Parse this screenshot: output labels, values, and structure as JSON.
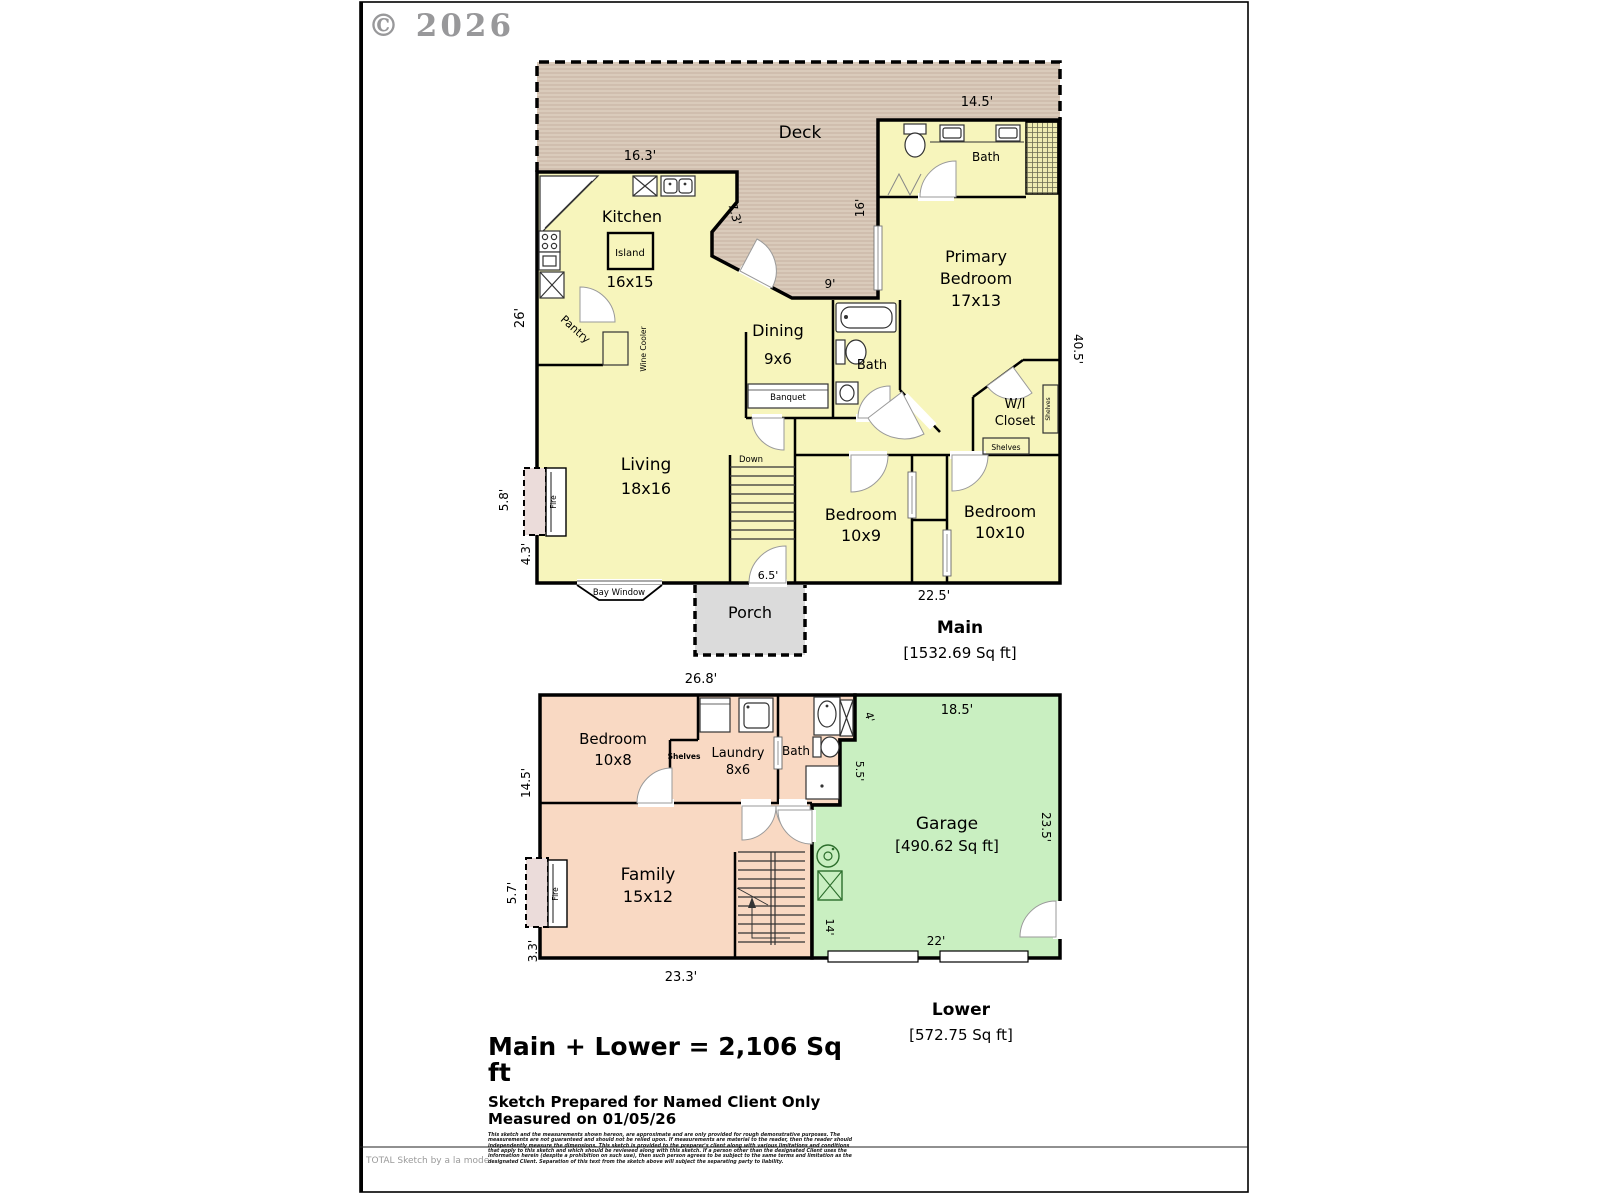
{
  "watermark": "© 2026",
  "main": {
    "title": "Main",
    "area": "[1532.69 Sq ft]",
    "deck": "Deck",
    "kitchen": "Kitchen",
    "kitchen_size": "16x15",
    "island": "Island",
    "pantry": "Pantry",
    "wine_cooler": "Wine Cooler",
    "dining": "Dining",
    "dining_size": "9x6",
    "banquet": "Banquet",
    "bath_top": "Bath",
    "bath_mid": "Bath",
    "primary_line1": "Primary",
    "primary_line2": "Bedroom",
    "primary_size": "17x13",
    "wic_line1": "W/I",
    "wic_line2": "Closet",
    "shelves_strip": "Shelves",
    "shelves_box": "Shelves",
    "living": "Living",
    "living_size": "18x16",
    "down": "Down",
    "fire": "Fire",
    "bed1": "Bedroom",
    "bed1_size": "10x9",
    "bed2": "Bedroom",
    "bed2_size": "10x10",
    "bay_window": "Bay Window",
    "porch": "Porch",
    "dims": {
      "k_top": "16.3'",
      "deck_right": "14.5'",
      "k_right": "7.3'",
      "deck_wall": "16'",
      "dine_top": "9'",
      "left": "26'",
      "fire_w": "5.8'",
      "below_fire": "4.3'",
      "entry": "6.5'",
      "bottom": "22.5'",
      "right": "40.5'"
    }
  },
  "lower": {
    "title": "Lower",
    "area": "[572.75 Sq ft]",
    "bedroom": "Bedroom",
    "bedroom_size": "10x8",
    "shelves": "Shelves",
    "laundry": "Laundry",
    "laundry_size": "8x6",
    "bath": "Bath",
    "garage": "Garage",
    "garage_area": "[490.62 Sq ft]",
    "family": "Family",
    "family_size": "15x12",
    "fire": "Fire",
    "dims": {
      "top": "26.8'",
      "left": "14.5'",
      "g_notch1": "4'",
      "g_notch2": "5.5'",
      "g_top": "18.5'",
      "g_right": "23.5'",
      "g_left": "14'",
      "g_bottom": "22'",
      "fire_w": "5.7'",
      "below_fire": "3.3'",
      "bottom": "23.3'"
    }
  },
  "summary": {
    "total": "Main + Lower = 2,106 Sq ft",
    "prepared_for": "Sketch Prepared for Named Client Only",
    "measured_on": "Measured on 01/05/26",
    "disclaimer": "This sketch and the measurements shown hereon, are approximate and are only provided for rough demonstrative purposes.  The measurements are not guaranteed and should not be relied upon.  If measurements are material to the reader, then the reader should independently measure the dimensions.  This sketch is provided to the preparer's client along with various limitations and conditions that apply to this sketch and which should be reviewed along with this sketch.  If a person other than the designated Client uses the information herein (despite a prohibition on such use), then such person agrees to be subject to the same terms and limitation as the designated Client.  Separation of this text from the sketch above will subject the separating party to liability."
  },
  "footer": {
    "brand": "TOTAL Sketch by a la mode"
  },
  "colors": {
    "room_yellow": "#F7F5BC",
    "deck_tan": "#DACBBB",
    "salmon": "#F9D9C3",
    "garage_green": "#C9EFC1",
    "porch_gray": "#DBDBDB",
    "fire_pink": "#EBDCDA"
  }
}
